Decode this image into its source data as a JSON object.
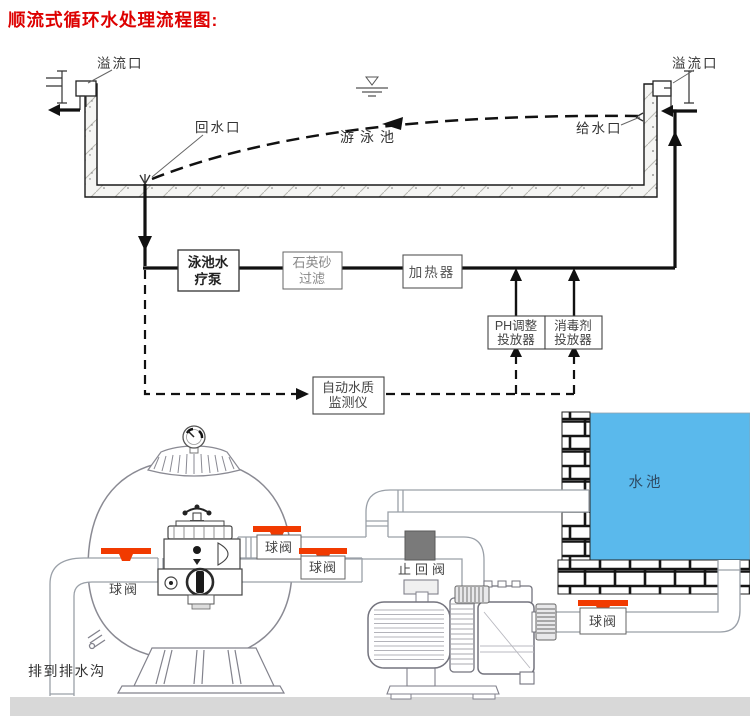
{
  "title": "顺流式循环水处理流程图:",
  "pool": {
    "overflow_left": "溢流口",
    "overflow_right": "溢流口",
    "return_port": "回水口",
    "supply_port": "给水口",
    "pool_name": "游泳池",
    "boxes": {
      "pump": {
        "line1": "泳池水",
        "line2": "疗泵"
      },
      "sand_filter": {
        "line1": "石英砂",
        "line2": "过滤"
      },
      "heater": {
        "label": "加热器"
      },
      "ph_doser": {
        "line1": "PH调整",
        "line2": "投放器"
      },
      "disinfectant": {
        "line1": "消毒剂",
        "line2": "投放器"
      },
      "monitor": {
        "line1": "自动水质",
        "line2": "监测仪"
      }
    }
  },
  "equip": {
    "valves": {
      "left": "球阀",
      "filter_out": "球阀",
      "pump_in": "球阀",
      "tank": "球阀"
    },
    "check_valve": "止回阀",
    "water_tank": "水池",
    "drain_note": "排到排水沟"
  },
  "colors": {
    "title_red": "#dd0000",
    "valve_orange": "#f13a00",
    "water_blue": "#5ab9ec",
    "check_valve_gray": "#7a7a7a",
    "ground_gray": "#d8d8d8",
    "line_black": "#111111"
  }
}
